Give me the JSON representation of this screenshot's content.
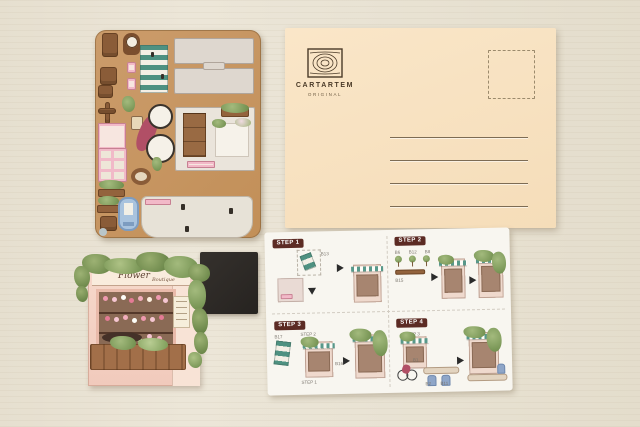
{
  "scene": {
    "surface": "light wood table",
    "surface_color": "#e9e3d4"
  },
  "punch_sheet": {
    "board_color": "#c6935f",
    "awning_color": "#4e9181",
    "bicycle_color": "#b14f66",
    "pink_color": "#f2b9c8",
    "door_color": "#a9c3de",
    "piece_icons": [
      "chair-icon",
      "clock-icon",
      "awning-icon",
      "bicycle-icon",
      "window-frame-icon",
      "cabinet-icon",
      "planter-crate-icon",
      "door-icon",
      "floor-panel-icon",
      "lamp-icon"
    ]
  },
  "postcard": {
    "paper_color": "#f8e2c0",
    "brand": "CARTARTEM",
    "brand_tagline": "ORIGINAL",
    "address_line_count": 4
  },
  "magnet": {
    "color": "#2c2927"
  },
  "model": {
    "sign_line1": "Flower",
    "sign_line2": "Boutique"
  },
  "instructions": {
    "badge_color": "#5c2b24",
    "steps": [
      {
        "label": "STEP 1",
        "parts": [
          "B13"
        ]
      },
      {
        "label": "STEP 2",
        "parts": [
          "B6",
          "B12",
          "B8",
          "B15"
        ]
      },
      {
        "label": "STEP 3",
        "parts": [
          "B17",
          "STEP 2",
          "B16",
          "STEP 1"
        ]
      },
      {
        "label": "STEP 4",
        "parts": [
          "STEP 3",
          "B1",
          "B2",
          "B11"
        ]
      }
    ]
  }
}
